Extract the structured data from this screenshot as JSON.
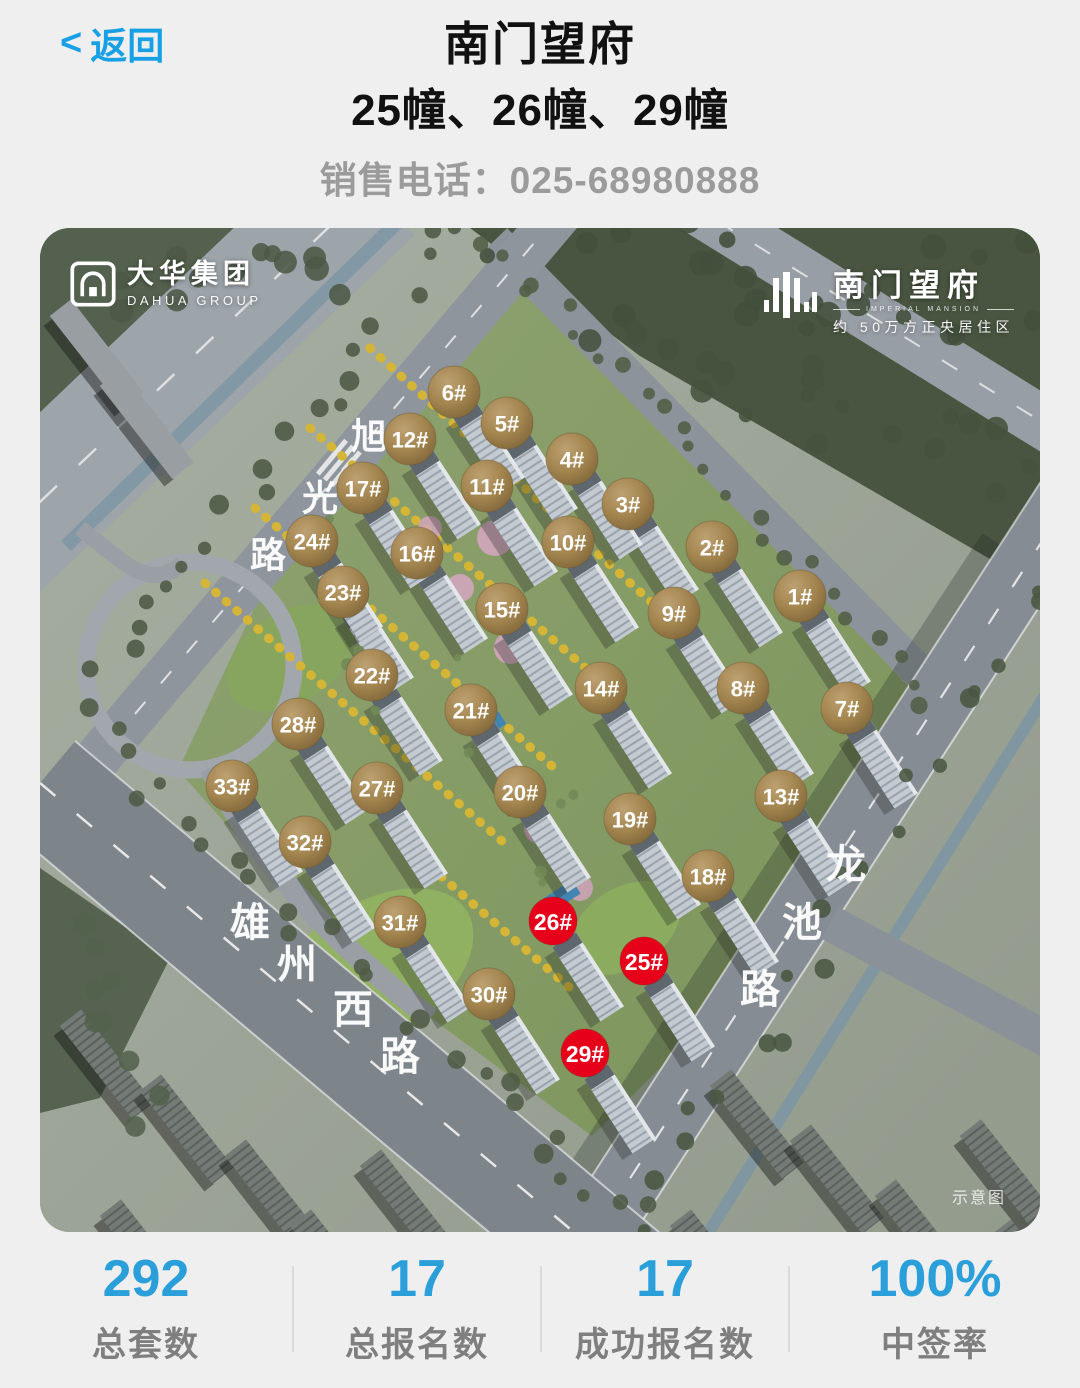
{
  "header": {
    "back_chevron": "<",
    "back_label": "返回",
    "title": "南门望府",
    "subtitle": "25幢、26幢、29幢",
    "phone_label": "销售电话：",
    "phone_number": "025-68980888"
  },
  "image": {
    "developer_logo": {
      "cn": "大华集团",
      "en": "DAHUA GROUP"
    },
    "project_logo": {
      "cn": "南门望府",
      "en": "IMPERIAL MANSION",
      "tagline": "约 50万方正央居住区"
    },
    "watermark": "示意图",
    "road_labels": [
      {
        "name": "旭光路",
        "font_size": 36,
        "chars": [
          {
            "c": "旭",
            "x": 329,
            "y": 208
          },
          {
            "c": "光",
            "x": 280,
            "y": 270
          },
          {
            "c": "路",
            "x": 228,
            "y": 327
          }
        ]
      },
      {
        "name": "雄州西路",
        "font_size": 40,
        "chars": [
          {
            "c": "雄",
            "x": 210,
            "y": 695
          },
          {
            "c": "州",
            "x": 257,
            "y": 737
          },
          {
            "c": "西",
            "x": 313,
            "y": 782
          },
          {
            "c": "路",
            "x": 360,
            "y": 829
          }
        ]
      },
      {
        "name": "龙池路",
        "font_size": 40,
        "chars": [
          {
            "c": "龙",
            "x": 806,
            "y": 637
          },
          {
            "c": "池",
            "x": 762,
            "y": 695
          },
          {
            "c": "路",
            "x": 720,
            "y": 762
          }
        ]
      }
    ],
    "markers": [
      {
        "label": "1#",
        "x": 760,
        "y": 368,
        "type": "gold"
      },
      {
        "label": "2#",
        "x": 672,
        "y": 319,
        "type": "gold"
      },
      {
        "label": "3#",
        "x": 588,
        "y": 276,
        "type": "gold"
      },
      {
        "label": "4#",
        "x": 532,
        "y": 231,
        "type": "gold"
      },
      {
        "label": "5#",
        "x": 467,
        "y": 195,
        "type": "gold"
      },
      {
        "label": "6#",
        "x": 414,
        "y": 164,
        "type": "gold"
      },
      {
        "label": "7#",
        "x": 807,
        "y": 480,
        "type": "gold"
      },
      {
        "label": "8#",
        "x": 703,
        "y": 460,
        "type": "gold"
      },
      {
        "label": "9#",
        "x": 634,
        "y": 385,
        "type": "gold"
      },
      {
        "label": "10#",
        "x": 528,
        "y": 314,
        "type": "gold"
      },
      {
        "label": "11#",
        "x": 447,
        "y": 258,
        "type": "gold"
      },
      {
        "label": "12#",
        "x": 370,
        "y": 211,
        "type": "gold"
      },
      {
        "label": "13#",
        "x": 741,
        "y": 568,
        "type": "gold"
      },
      {
        "label": "14#",
        "x": 561,
        "y": 460,
        "type": "gold"
      },
      {
        "label": "15#",
        "x": 462,
        "y": 381,
        "type": "gold"
      },
      {
        "label": "16#",
        "x": 377,
        "y": 325,
        "type": "gold"
      },
      {
        "label": "17#",
        "x": 323,
        "y": 260,
        "type": "gold"
      },
      {
        "label": "18#",
        "x": 668,
        "y": 648,
        "type": "gold"
      },
      {
        "label": "19#",
        "x": 590,
        "y": 591,
        "type": "gold"
      },
      {
        "label": "20#",
        "x": 480,
        "y": 564,
        "type": "gold"
      },
      {
        "label": "21#",
        "x": 431,
        "y": 482,
        "type": "gold"
      },
      {
        "label": "22#",
        "x": 332,
        "y": 447,
        "type": "gold"
      },
      {
        "label": "23#",
        "x": 303,
        "y": 364,
        "type": "gold"
      },
      {
        "label": "24#",
        "x": 272,
        "y": 313,
        "type": "gold"
      },
      {
        "label": "25#",
        "x": 604,
        "y": 733,
        "type": "red"
      },
      {
        "label": "26#",
        "x": 513,
        "y": 693,
        "type": "red"
      },
      {
        "label": "27#",
        "x": 337,
        "y": 560,
        "type": "gold"
      },
      {
        "label": "28#",
        "x": 258,
        "y": 496,
        "type": "gold"
      },
      {
        "label": "29#",
        "x": 545,
        "y": 825,
        "type": "red"
      },
      {
        "label": "30#",
        "x": 449,
        "y": 766,
        "type": "gold"
      },
      {
        "label": "31#",
        "x": 360,
        "y": 694,
        "type": "gold"
      },
      {
        "label": "32#",
        "x": 265,
        "y": 614,
        "type": "gold"
      },
      {
        "label": "33#",
        "x": 192,
        "y": 558,
        "type": "gold"
      }
    ]
  },
  "stats": [
    {
      "value": "292",
      "label": "总套数"
    },
    {
      "value": "17",
      "label": "总报名数"
    },
    {
      "value": "17",
      "label": "成功报名数"
    },
    {
      "value": "100%",
      "label": "中签率"
    }
  ],
  "colors": {
    "accent_blue": "#18a0e4",
    "stat_blue": "#2a9fd9",
    "phone_gray": "#9b9b9b",
    "marker_gold": "#a3854f",
    "marker_red": "#e60019"
  }
}
